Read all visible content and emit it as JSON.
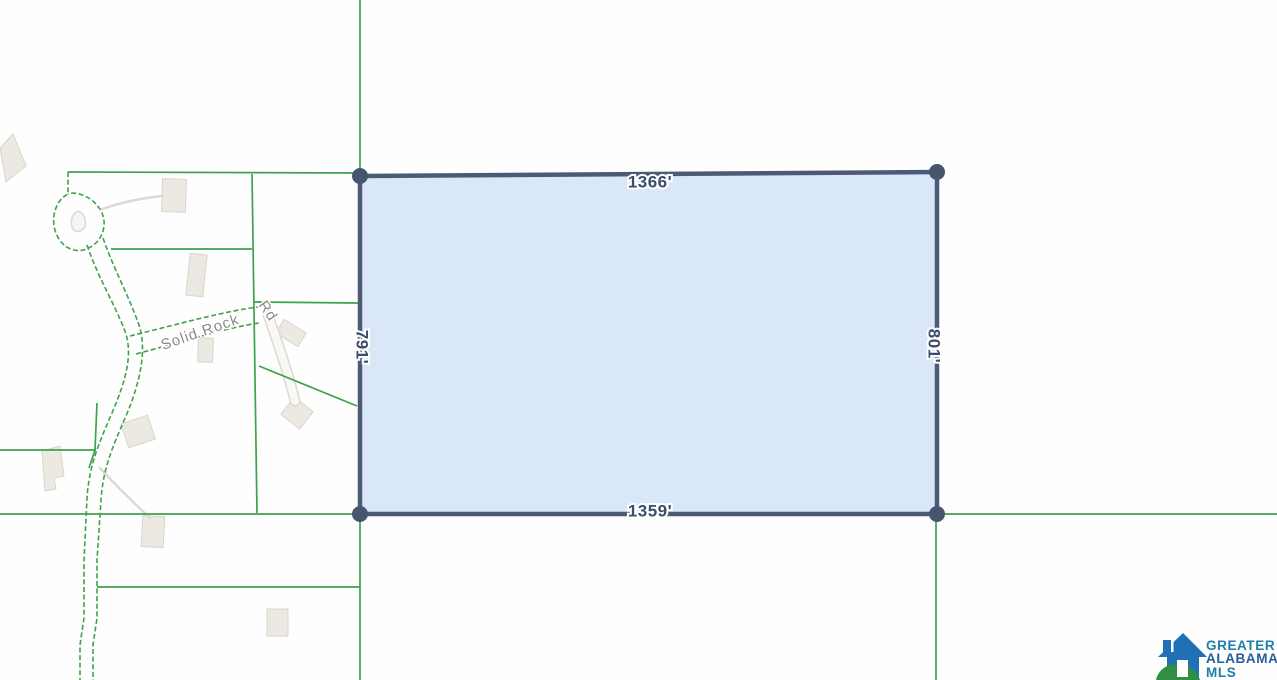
{
  "map": {
    "type": "parcel-plat-map",
    "road": {
      "name": "Solid Rock Rd",
      "label_part1": "Solid Rock",
      "label_part2": "Rd"
    },
    "subject_parcel": {
      "dimensions": {
        "top": "1366'",
        "left": "791'",
        "right": "801'",
        "bottom": "1359'"
      }
    }
  },
  "colors": {
    "parcel_fill": "#d9e7f9",
    "parcel_border": "#4c5a77",
    "corner_dot": "#47556f",
    "dimension_text": "#3c4c6b",
    "boundary_green": "#3ea14b",
    "building_fill": "#ece9e3",
    "road_label_gray": "#8b8b8b",
    "logo_house_blue": "#2170b5",
    "logo_hill_green": "#2f8f43",
    "logo_teal": "#1d7fa8",
    "logo_navy": "#255d9b"
  },
  "logo": {
    "line1": "GREATER",
    "line2": "ALABAMA",
    "line3": "MLS"
  }
}
